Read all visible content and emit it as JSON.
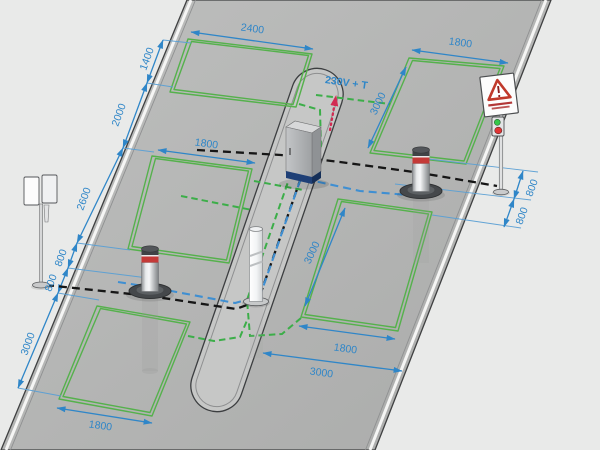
{
  "diagram": {
    "supply_label": "230V + T",
    "dimensions": {
      "left_chain": [
        "1400",
        "2000",
        "2600",
        "800",
        "800",
        "3000"
      ],
      "right_chain": [
        "800",
        "800"
      ],
      "loop_a_width": "2400",
      "loop_b_width": "1800",
      "loop_c_width": "1800",
      "loop_d_width": "1800",
      "loop_d_length": "3000",
      "loop_e_width": "1800",
      "loop_e_length": "3000",
      "road_width": "3000"
    },
    "colors": {
      "background": "#e9eae9",
      "road_gray": "#b4b5b4",
      "island_gray": "#c6c7c6",
      "dimension_blue": "#2f86c8",
      "loop_green": "#55b14c",
      "cable_black": "#161616",
      "cable_blue": "#3f8fd2",
      "cable_green": "#3cae49",
      "supply_red": "#d22a52",
      "cabinet_base_blue": "#1e3f76",
      "bollard_stripe_red": "#c43a38",
      "signal_green": "#35c84a",
      "signal_red": "#e13434"
    }
  }
}
